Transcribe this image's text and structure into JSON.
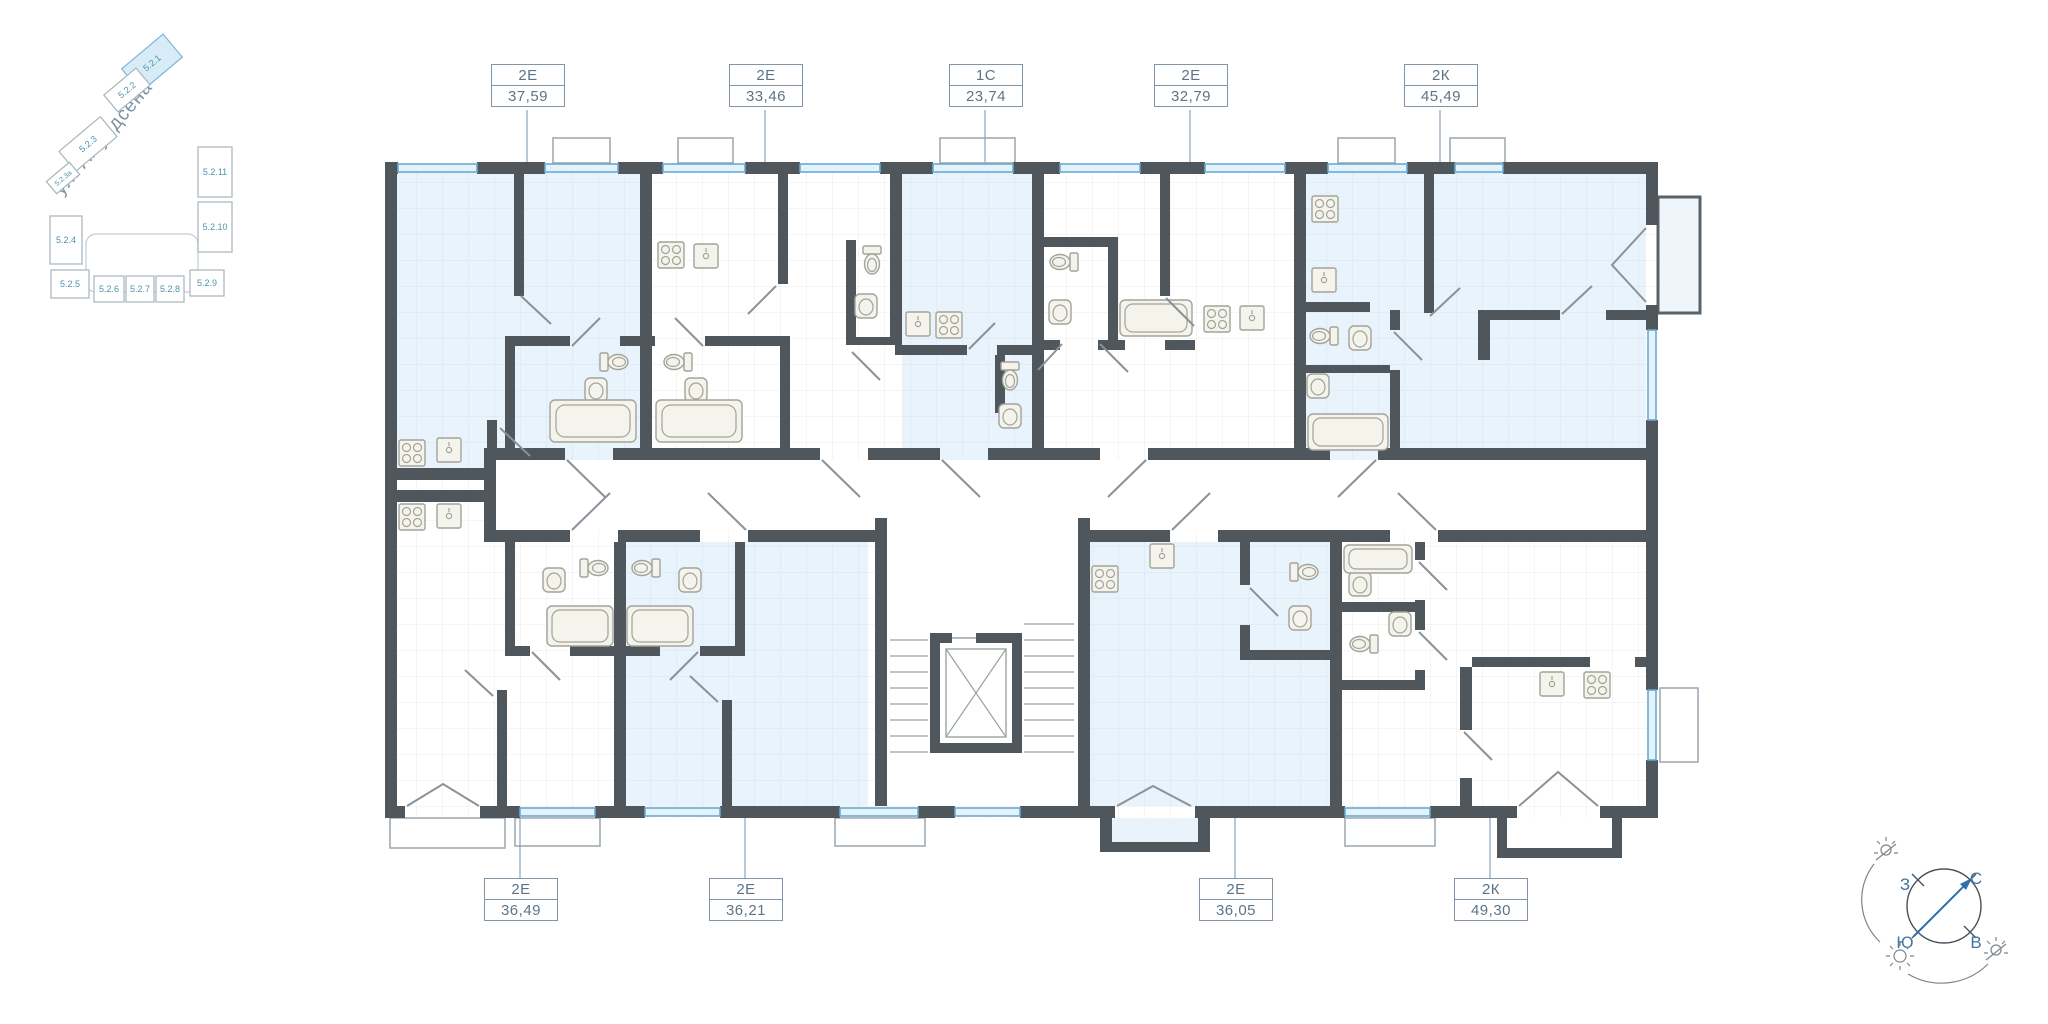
{
  "minimap": {
    "street": "ул. Амундсена",
    "blocks": [
      {
        "id": "5.2.1",
        "highlighted": true
      },
      {
        "id": "5.2.2",
        "highlighted": false
      },
      {
        "id": "5.2.3",
        "highlighted": false
      },
      {
        "id": "5.2.3а",
        "highlighted": false
      },
      {
        "id": "5.2.4",
        "highlighted": false
      },
      {
        "id": "5.2.5",
        "highlighted": false
      },
      {
        "id": "5.2.6",
        "highlighted": false
      },
      {
        "id": "5.2.7",
        "highlighted": false
      },
      {
        "id": "5.2.8",
        "highlighted": false
      },
      {
        "id": "5.2.9",
        "highlighted": false
      },
      {
        "id": "5.2.10",
        "highlighted": false
      },
      {
        "id": "5.2.11",
        "highlighted": false
      }
    ]
  },
  "apartments": {
    "top": [
      {
        "type": "2Е",
        "area": "37,59"
      },
      {
        "type": "2Е",
        "area": "33,46"
      },
      {
        "type": "1С",
        "area": "23,74"
      },
      {
        "type": "2Е",
        "area": "32,79"
      },
      {
        "type": "2К",
        "area": "45,49"
      }
    ],
    "bottom": [
      {
        "type": "2Е",
        "area": "36,49"
      },
      {
        "type": "2Е",
        "area": "36,21"
      },
      {
        "type": "2Е",
        "area": "36,05"
      },
      {
        "type": "2К",
        "area": "49,30"
      }
    ]
  },
  "compass": {
    "west": "З",
    "north": "С",
    "south": "Ю",
    "east": "В"
  },
  "colors": {
    "wall": "#4f565c",
    "highlight_room": "#e9f3fb",
    "window": "#69a9d2",
    "label_text": "#5d7487",
    "minimap_accent": "#4e93ad"
  }
}
